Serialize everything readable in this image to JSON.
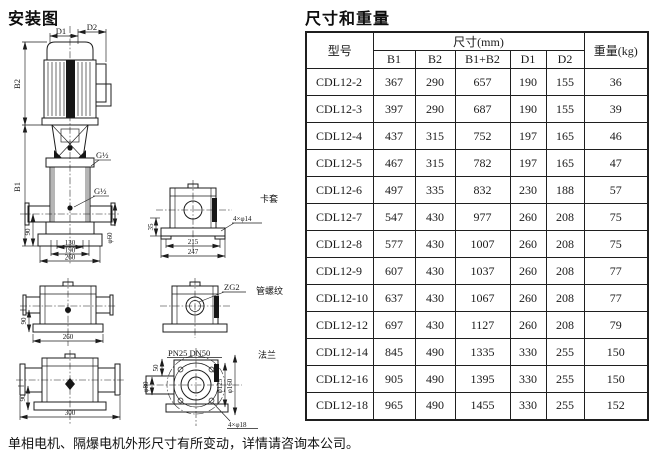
{
  "page": {
    "background": "#ffffff",
    "line_color": "#1c1c1c"
  },
  "left": {
    "title": "安装图",
    "main_view": {
      "dim_d1": "D1",
      "dim_d2": "D2",
      "dim_b2": "B2",
      "dim_b1": "B1",
      "port_top": "G½",
      "port_bottom": "G½",
      "dim_90": "90",
      "dim_130": "130",
      "dim_190": "190",
      "dim_260": "260",
      "dim_phi60": "φ60"
    },
    "clamp_view": {
      "label": "卡套",
      "dim_35": "35",
      "dim_215": "215",
      "dim_247": "247",
      "holes": "4×φ14"
    },
    "mid_view": {
      "dim_90": "90",
      "dim_260": "260"
    },
    "thread_view": {
      "thread": "ZG2",
      "label": "管螺纹"
    },
    "bottom_view": {
      "dim_90": "90",
      "dim_300": "300"
    },
    "flange_view": {
      "label": "法兰",
      "rating": "PN25 DN50",
      "dim_50": "50",
      "dim_phi80": "φ80",
      "dim_phi125": "φ125",
      "dim_phi160": "φ160",
      "holes": "4×φ18"
    }
  },
  "table": {
    "title": "尺寸和重量",
    "header": {
      "model": "型号",
      "dims_group": "尺寸(mm)",
      "columns": [
        "B1",
        "B2",
        "B1+B2",
        "D1",
        "D2"
      ],
      "weight": "重量(kg)"
    },
    "rows": [
      [
        "CDL12-2",
        "367",
        "290",
        "657",
        "190",
        "155",
        "36"
      ],
      [
        "CDL12-3",
        "397",
        "290",
        "687",
        "190",
        "155",
        "39"
      ],
      [
        "CDL12-4",
        "437",
        "315",
        "752",
        "197",
        "165",
        "46"
      ],
      [
        "CDL12-5",
        "467",
        "315",
        "782",
        "197",
        "165",
        "47"
      ],
      [
        "CDL12-6",
        "497",
        "335",
        "832",
        "230",
        "188",
        "57"
      ],
      [
        "CDL12-7",
        "547",
        "430",
        "977",
        "260",
        "208",
        "75"
      ],
      [
        "CDL12-8",
        "577",
        "430",
        "1007",
        "260",
        "208",
        "75"
      ],
      [
        "CDL12-9",
        "607",
        "430",
        "1037",
        "260",
        "208",
        "77"
      ],
      [
        "CDL12-10",
        "637",
        "430",
        "1067",
        "260",
        "208",
        "77"
      ],
      [
        "CDL12-12",
        "697",
        "430",
        "1127",
        "260",
        "208",
        "79"
      ],
      [
        "CDL12-14",
        "845",
        "490",
        "1335",
        "330",
        "255",
        "150"
      ],
      [
        "CDL12-16",
        "905",
        "490",
        "1395",
        "330",
        "255",
        "150"
      ],
      [
        "CDL12-18",
        "965",
        "490",
        "1455",
        "330",
        "255",
        "152"
      ]
    ]
  },
  "footer": {
    "note": "单相电机、隔爆电机外形尺寸有所变动，详情请咨询本公司。"
  }
}
